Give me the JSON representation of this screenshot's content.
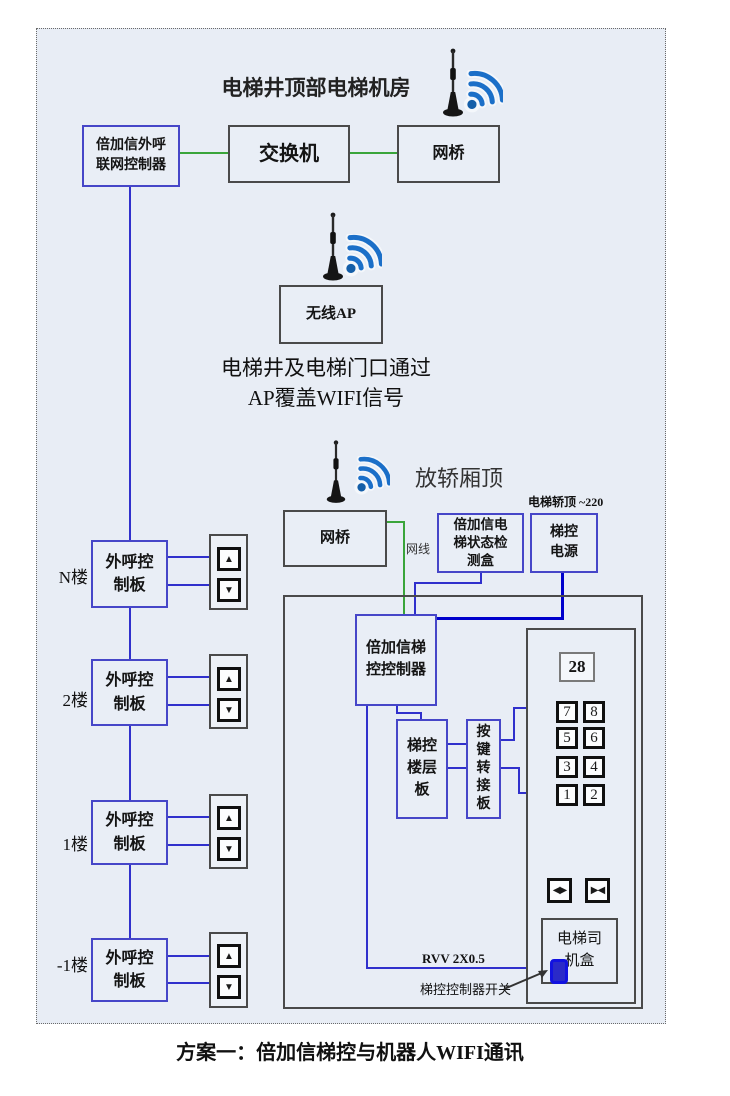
{
  "diagram": {
    "machine_room": {
      "title": "电梯井顶部电梯机房",
      "call_controller": "倍加信外呼\n联网控制器",
      "switch": "交换机",
      "bridge": "网桥"
    },
    "ap": {
      "box": "无线AP",
      "note1": "电梯井及电梯门口通过",
      "note2": "AP覆盖WIFI信号"
    },
    "car": {
      "title": "放轿厢顶",
      "bridge": "网桥",
      "cable": "网线",
      "power_note": "电梯轿顶 ~220",
      "status_box": "倍加信电\n梯状态检\n测盒",
      "power_box": "梯控\n电源",
      "controller": "倍加信梯\n控控制器",
      "floor_board": "梯控\n楼层\n板",
      "key_board": "按\n键\n转\n接\n板",
      "display": "28",
      "buttons": [
        "7",
        "8",
        "5",
        "6",
        "3",
        "4",
        "1",
        "2"
      ],
      "driver_box": "电梯司\n机盒",
      "cable_spec": "RVV 2X0.5",
      "switch_label": "梯控控制器开关"
    },
    "floors": {
      "board": "外呼控\n制板",
      "items": [
        {
          "label": "N楼"
        },
        {
          "label": "2楼"
        },
        {
          "label": "1楼"
        },
        {
          "label": "-1楼"
        }
      ]
    },
    "caption": "方案一：倍加信梯控与机器人WIFI通讯",
    "icons": {
      "up": "▲",
      "down": "▼",
      "door_open": "◀▶",
      "door_close": "▶◀",
      "wifi": "wifi-signal-icon",
      "antenna": "antenna-icon"
    },
    "colors": {
      "panel_bg": "#e8edf5",
      "wire_blue": "#3030cc",
      "wire_green": "#3aa53a",
      "wire_thick_blue": "#0000cc",
      "box_border_blue": "#4646c8",
      "wifi_blue": "#1b6fc8"
    }
  }
}
